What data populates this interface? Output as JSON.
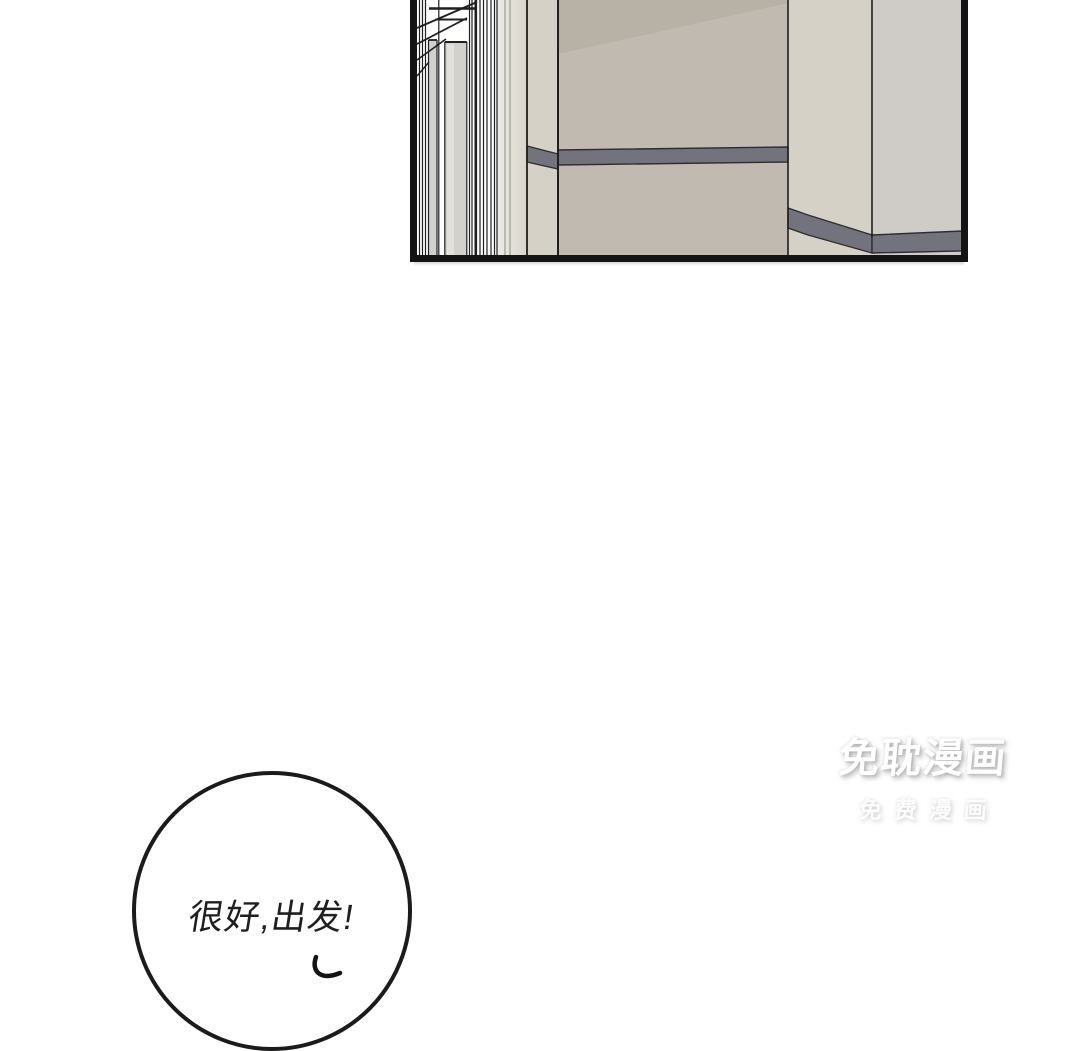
{
  "page": {
    "background": "#ffffff",
    "kind": "comic page"
  },
  "panel": {
    "scene": "empty hallway interior, nested door frames at left, beige walls with gray wainscot stripe",
    "colors": {
      "border": "#141414",
      "line": "#1f1f1f",
      "wall_center": "#c0bab0",
      "wall_center_shade": "#aca69b",
      "face_left": "#d6d1c6",
      "face_right": "#d5d1c7",
      "wall_right": "#cfccc7",
      "stripe": "#73737e",
      "stripe_edge": "#2d2d33",
      "door_panel": "#d3d1cc",
      "door_panel_small": "#d0d0cd",
      "door_panel_highlight": "#e3e1dc",
      "hall_bg": "#ffffff"
    }
  },
  "watermark": {
    "title": "免耽漫画",
    "subtitle": "免费漫画",
    "color": "#ffffff"
  },
  "speech_bubble": {
    "text": "很好,出发!",
    "border_color": "#1b1b1b",
    "text_color": "#1f1f1f"
  }
}
